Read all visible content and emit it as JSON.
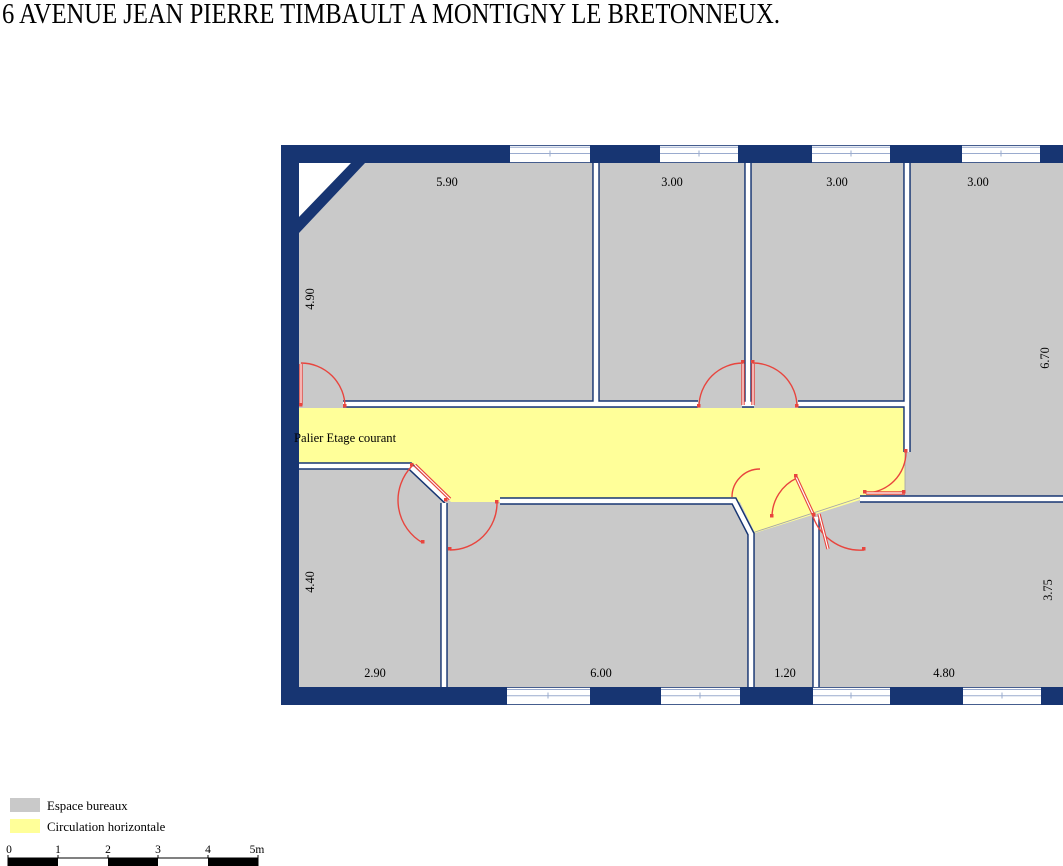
{
  "title": "6 AVENUE JEAN PIERRE TIMBAULT A MONTIGNY LE BRETONNEUX.",
  "floor_plan": {
    "corridor_label": "Palier Etage courant",
    "dims": {
      "top": [
        "5.90",
        "3.00",
        "3.00",
        "3.00"
      ],
      "bottom": [
        "2.90",
        "6.00",
        "1.20",
        "4.80"
      ],
      "left": [
        "4.90",
        "4.40"
      ],
      "right": [
        "6.70",
        "3.75"
      ]
    }
  },
  "legend": {
    "items": [
      {
        "label": "Espace bureaux",
        "color": "#c9c9c9"
      },
      {
        "label": "Circulation horizontale",
        "color": "#ffff99"
      }
    ]
  },
  "scale_bar": {
    "labels": [
      "0",
      "1",
      "2",
      "3",
      "4",
      "5m"
    ]
  },
  "colors": {
    "wall": "#173572",
    "office_gray": "#c9c9c9",
    "circulation_yellow": "#ffff99",
    "door_red": "#e8453e",
    "window_line": "#9aabce"
  }
}
